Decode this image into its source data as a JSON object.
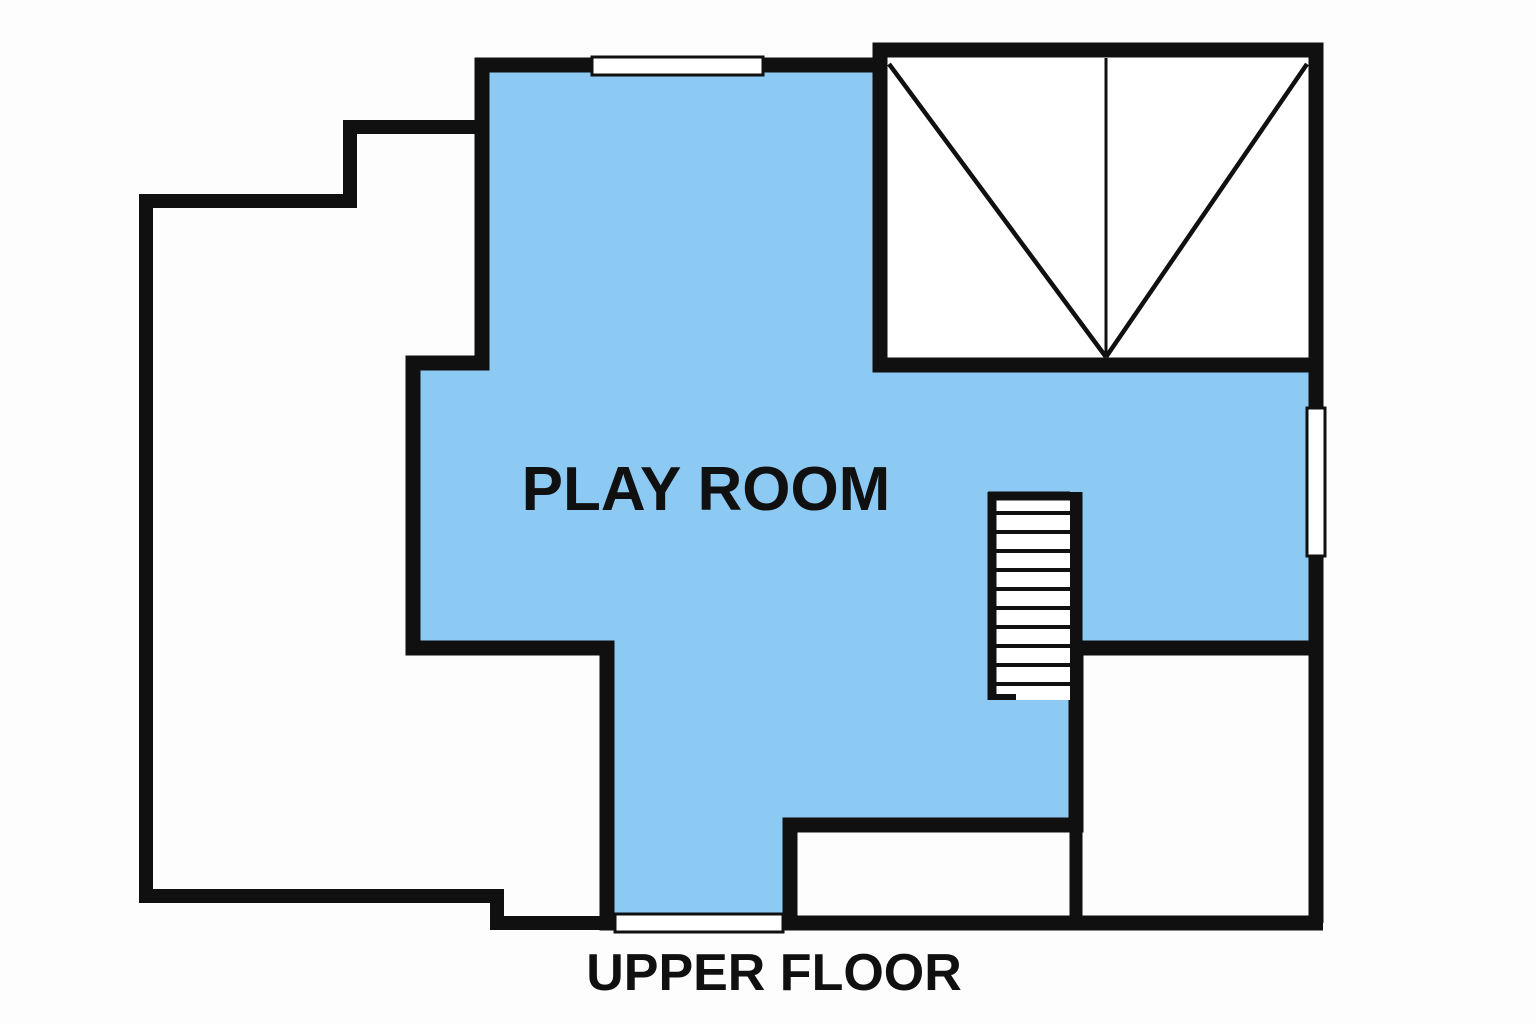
{
  "labels": {
    "play_room": "PLAY ROOM",
    "floor_title": "UPPER FLOOR"
  },
  "colors": {
    "play_room_fill": "#8ccaf3",
    "wall": "#101010",
    "background": "#fdfdfd",
    "text": "#101010"
  },
  "features": {
    "staircase_icon": "staircase",
    "top_window_icon": "window",
    "bottom_window_icon": "window",
    "right_window_icon": "window",
    "vaulted_room_icon": "roof-slope-lines"
  }
}
